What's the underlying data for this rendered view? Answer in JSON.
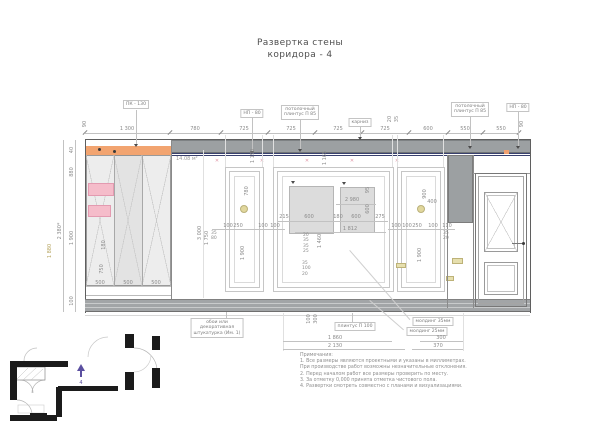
{
  "title": {
    "line1": "Развертка стены",
    "line2": "коридора - 4"
  },
  "area_label": "14.08 м²",
  "colors": {
    "curtain_rod_orange": "#f2a470",
    "mirror_pink": "#f5bcca",
    "ceiling_plinth_navy": "#39406e",
    "band_grey": "#9ca0a2",
    "plan_arrow_purple": "#5b4fa0",
    "sconce_olive": "#ded393"
  },
  "icons": {
    "curtain_hook": "✕"
  },
  "callouts": {
    "pk130": "ПК - 130",
    "np80_left": "НП - 80",
    "ceil_plinth_left": "потолочный\nплинтус П 85",
    "cornice": "карниз",
    "ceil_plinth_right": "потолочный\nплинтус П 85",
    "np80_right": "НП - 80",
    "wallpaper": "обои или\nдекоративная\nштукатурка (Им. 1)",
    "plinth": "плинтус П 100",
    "molding35": "молдинг 35мм",
    "molding25": "молдинг 25мм"
  },
  "dims": {
    "top": [
      "1 300",
      "780",
      "725",
      "725",
      "725",
      "725",
      "600",
      "550",
      "550"
    ],
    "top_rot_left": "90",
    "top_rot_right": "90",
    "top_small": [
      "20",
      "35"
    ],
    "left_chain": [
      "40",
      "880",
      "1 900",
      "100"
    ],
    "left_total": "2 380*",
    "left_yellow": "1 880",
    "height_rot": [
      "3 000",
      "1 750"
    ],
    "leader_rot": [
      "1 190",
      "1 165"
    ],
    "wardrobe": [
      "500",
      "500",
      "500"
    ],
    "wardrobe_rot": [
      "180",
      "750"
    ],
    "panel_a": {
      "w": "780",
      "h": "1 900",
      "chain": [
        "100",
        "250",
        "100",
        "100"
      ],
      "stack": "35\n80"
    },
    "center": {
      "total": "2 980",
      "chain": [
        "215",
        "600",
        "180",
        "600",
        "275"
      ],
      "mid": "1 812",
      "rot1": "95",
      "rot2": "600",
      "rot3": "1 460",
      "stack1": "20\n35\n35\n25",
      "stack2": "35\n100\n20"
    },
    "panel_c": {
      "h1": "900",
      "h2": "400",
      "h3": "1 900",
      "chain": [
        "100",
        "100",
        "250",
        "100",
        "110"
      ],
      "stack": "35\n20"
    },
    "bottom": {
      "d1": "1 860",
      "d2": "2 130",
      "d3": "300",
      "d4": "370",
      "stack_a": "100",
      "stack_b": "300"
    }
  },
  "notes": {
    "heading": "Примечания:",
    "lines": [
      "1. Все размеры являются проектными и указаны в миллиметрах.",
      "При производстве работ возможны незначительные отклонения.",
      "2. Перед началом работ все размеры проверить по месту.",
      "3. За отметку 0,000 принята отметка чистового пола.",
      "4. Развертки смотреть совместно с планами и визуализациями."
    ]
  },
  "plan": {
    "view_number": "4"
  }
}
